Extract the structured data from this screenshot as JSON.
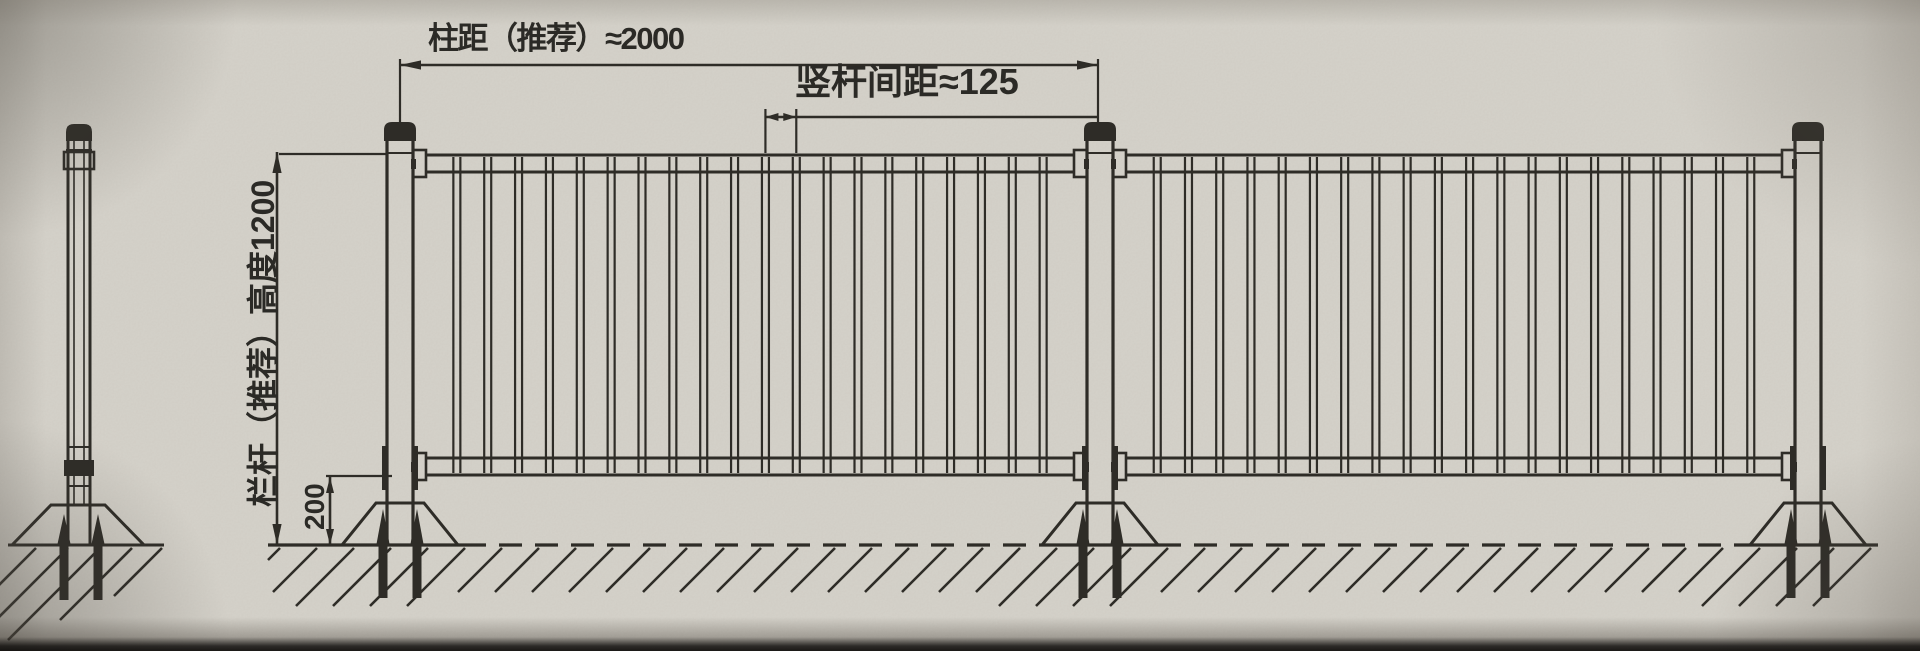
{
  "title": "护栏安装示意图",
  "annotations": {
    "post_spacing_label": "柱距（推荐）≈2000",
    "bar_spacing_label": "竖杆间距≈125",
    "height_label": "栏杆（推荐）高度1200",
    "base_height_label": "200"
  },
  "dimension_values": {
    "post_spacing_mm": 2000,
    "vertical_bar_spacing_mm": 125,
    "rail_height_mm": 1200,
    "base_exposure_mm": 200
  },
  "colors": {
    "paper": "#d7d4cc",
    "line": "#2e2c27",
    "text": "#2b2a26"
  },
  "drawing": {
    "ground_y": 545,
    "front": {
      "post_centers": [
        400,
        1100,
        1808
      ],
      "post_half": 13,
      "cap": {
        "half": 16,
        "top": 122,
        "bottom": 141
      },
      "collar_y": 153,
      "rails": {
        "top": [
          155,
          172
        ],
        "bottom": [
          458,
          475
        ]
      },
      "bracket": {
        "w": 13,
        "top_y": 150,
        "bottom_y": 453,
        "h": 27
      },
      "bars": {
        "per_panel": 20,
        "half": 3.5,
        "y1": 157,
        "y2": 473,
        "stroke": 2.2
      },
      "base": {
        "top_y": 503,
        "top_half": 24,
        "bottom_half": 58
      },
      "bolt": {
        "dx": 17,
        "tip_y": 509,
        "stem_bottom": 598,
        "half": 4.5
      },
      "ground_segments": [
        [
          268,
          463,
          "solid"
        ],
        [
          463,
          1042,
          "dashed"
        ],
        [
          1042,
          1158,
          "solid"
        ],
        [
          1158,
          1744,
          "dashed"
        ],
        [
          1744,
          1878,
          "solid"
        ]
      ],
      "hatch": {
        "x1": 280,
        "x2": 1878,
        "step": 37,
        "depth": 44,
        "deep_depth": 58
      }
    },
    "side": {
      "cx": 79,
      "half": 11,
      "core_half": 5,
      "cap": {
        "half": 13,
        "top": 124,
        "bottom": 141
      },
      "collar_y": 150,
      "top_box": [
        64,
        152,
        30,
        17
      ],
      "tie_y": 447,
      "bottom_box": [
        64,
        460,
        30,
        16
      ],
      "under_y": 486,
      "base": {
        "cx": 78,
        "top_y": 505,
        "top_half": 27,
        "bottom_half": 66
      },
      "bolts": [
        64,
        98
      ],
      "bolt": {
        "tip_y": 514,
        "stem_bottom": 600,
        "half": 4.5
      },
      "ground": [
        8,
        164
      ],
      "hatch_tops": [
        36,
        68,
        100,
        132,
        162
      ],
      "hatch_depths": [
        46,
        74,
        92,
        72,
        48
      ]
    },
    "dims": {
      "post_spacing": {
        "y": 65,
        "x1": 400,
        "x2": 1098,
        "ext_top": 59,
        "ext_bottom": 123
      },
      "bar_spacing": {
        "y": 117,
        "ext_top": 109,
        "ext_bottom": 153,
        "bar_idx": [
          11,
          12
        ],
        "tail_x": 1098,
        "arrow_len": 13
      },
      "height": {
        "x": 277,
        "y1": 152,
        "y2": 545,
        "ext": [
          279,
          154,
          388,
          154
        ]
      },
      "h200": {
        "x": 330,
        "y1": 477,
        "y2": 545,
        "ext": [
          326,
          476,
          392,
          476
        ]
      }
    }
  }
}
